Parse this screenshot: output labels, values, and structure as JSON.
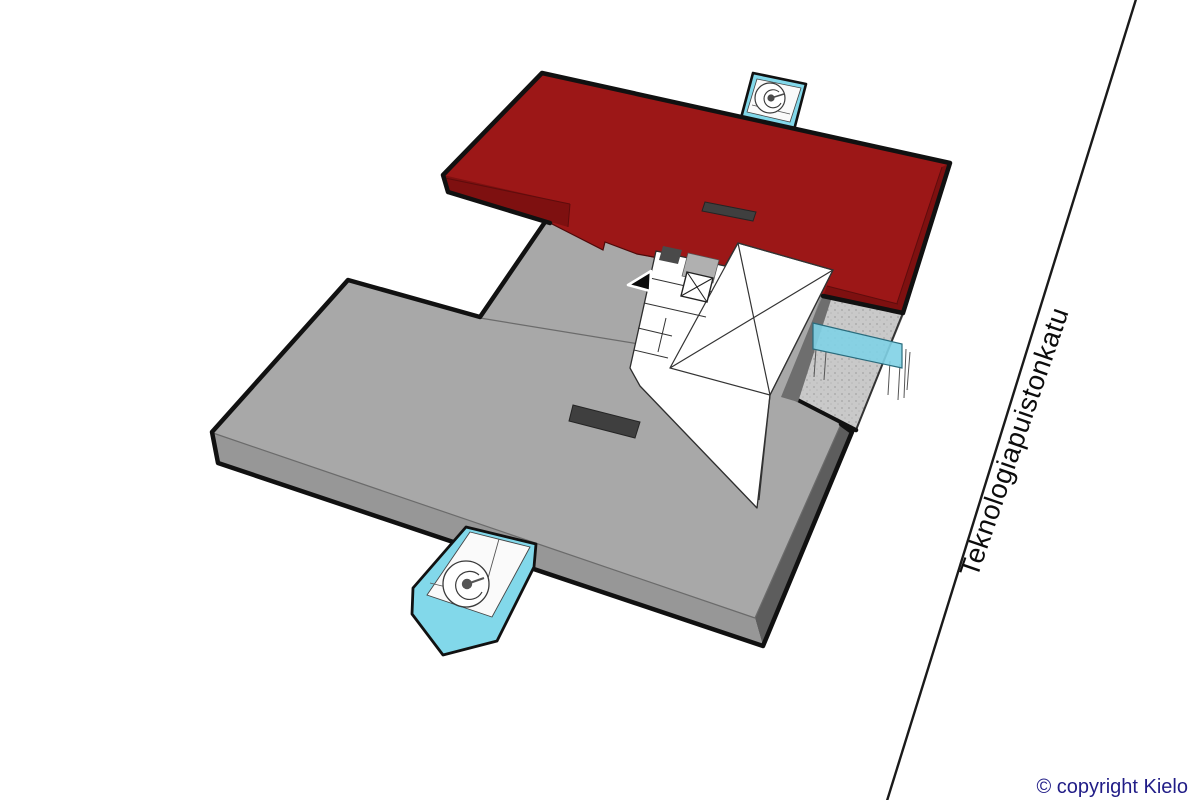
{
  "street": {
    "label": "Teknologiapuistonkatu"
  },
  "footer": {
    "copyright": "© copyright Kielo"
  },
  "colors": {
    "highlight_red": "#9c1717",
    "highlight_red_side": "#7e1010",
    "roof_gray": "#a8a8a8",
    "roof_gray_side_light": "#979797",
    "roof_gray_side_dark": "#5d5d5d",
    "terrace_gray": "#c9c9c9",
    "glass_cyan": "#82d8ea",
    "canopy_cyan": "#7fd2e6",
    "core_white": "#ffffff",
    "dark_hatch": "#3f3f3f",
    "outline_black": "#111111",
    "copyright_blue": "#211d87"
  },
  "scene": {
    "description": "Axonometric floor-plan diagram of a two-wing building beside a street",
    "highlighted_wing": "upper red floor slab",
    "lower_wing": "large gray floor slab",
    "core": "white service core with crossed skylight box, elevator shaft and stair rooms",
    "stair_towers": 2,
    "terrace": "stippled terrace with cyan glass canopy",
    "entrance_marker": "black triangle arrow"
  }
}
